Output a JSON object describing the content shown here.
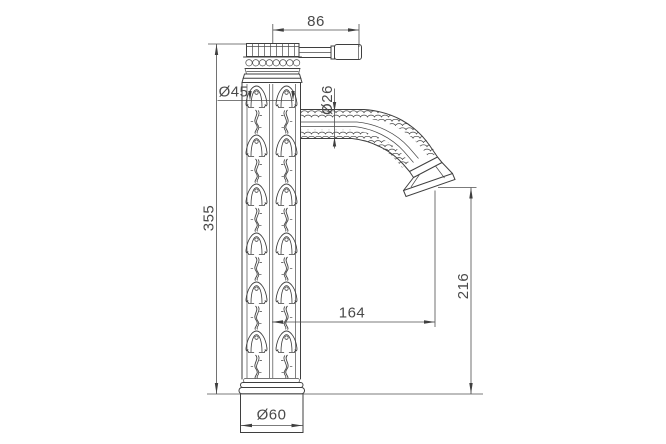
{
  "page": {
    "background": "#ffffff",
    "line_color": "#3f3f3f",
    "dimension_color": "#4f4f4f"
  },
  "drawing": {
    "dims": {
      "handle_length": "86",
      "body_diameter": "Ø45",
      "spout_tube_diameter": "Ø26",
      "overall_height": "355",
      "spout_reach": "164",
      "spout_outlet_height": "216",
      "base_diameter": "Ø60"
    }
  }
}
